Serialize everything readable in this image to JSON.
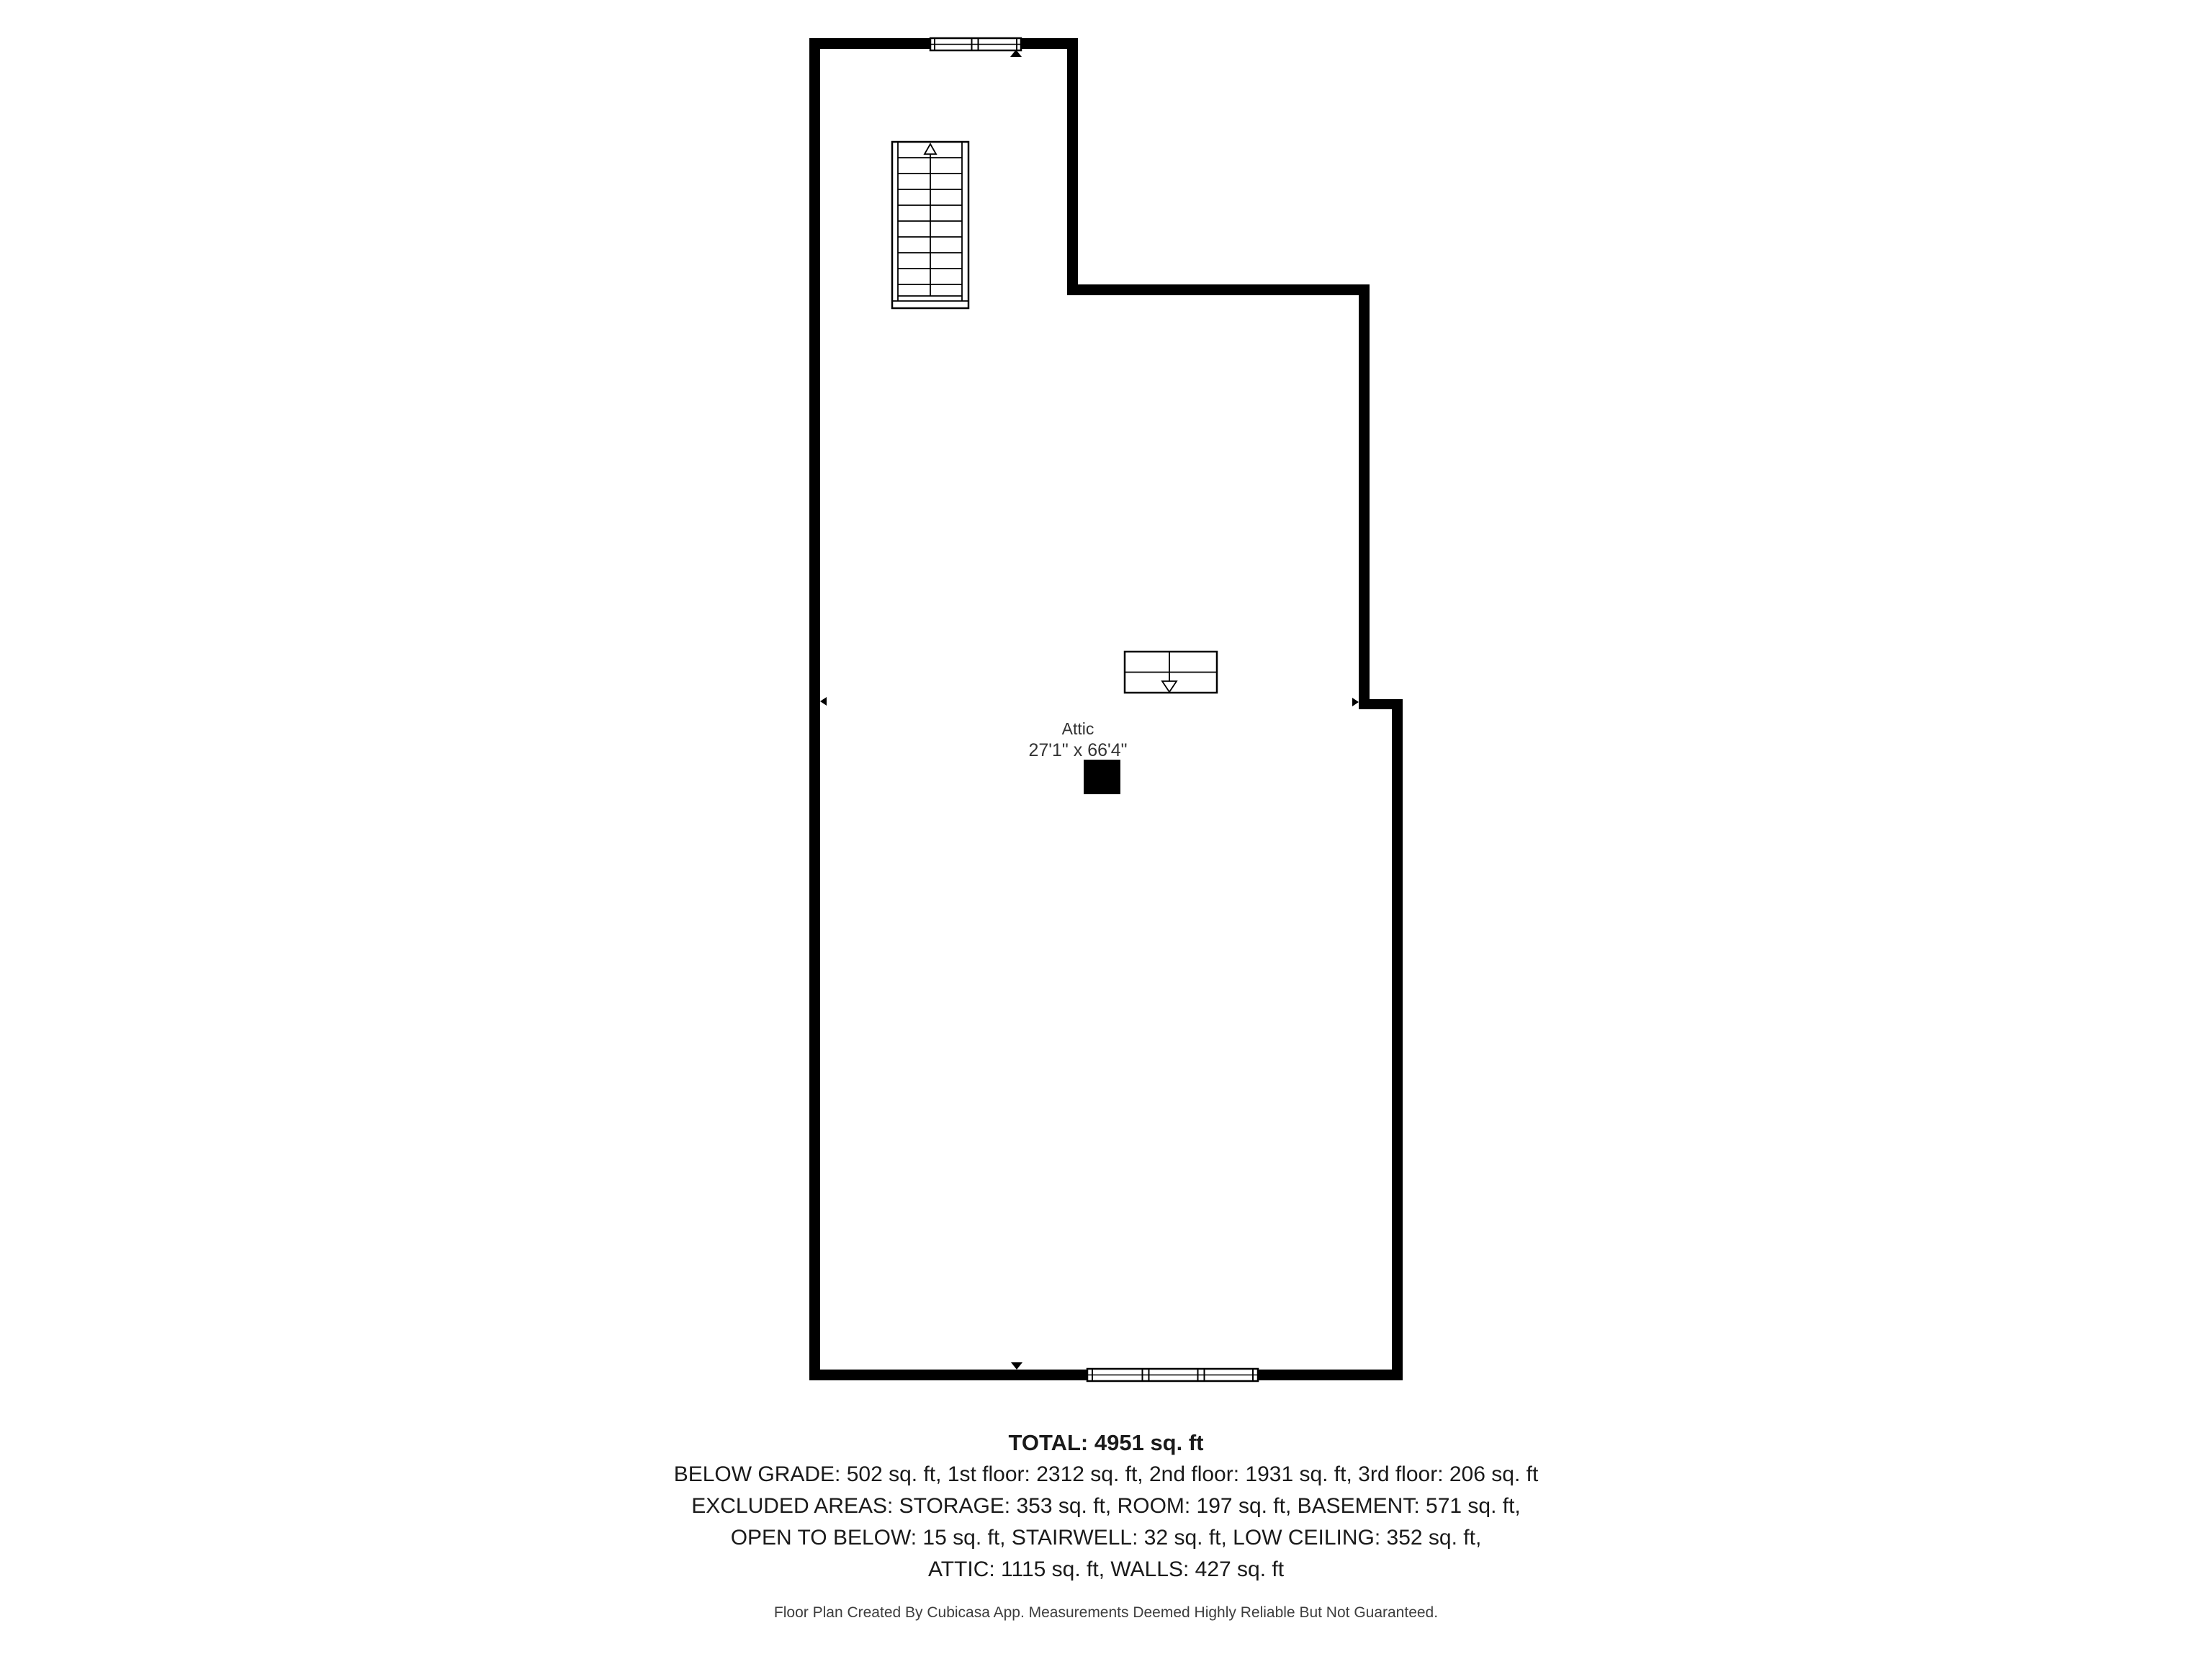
{
  "colors": {
    "wall": "#000000",
    "label_text": "#333333",
    "summary_text": "#1a1a1a",
    "footer_text": "#3d3d3d",
    "background": "#ffffff"
  },
  "plan": {
    "room_label": "Attic",
    "room_dimensions": "27'1\" x 66'4\""
  },
  "summary": {
    "total": "TOTAL: 4951 sq. ft",
    "lines": [
      "BELOW GRADE: 502 sq. ft, 1st floor: 2312 sq. ft, 2nd floor: 1931 sq. ft, 3rd floor: 206 sq. ft",
      "EXCLUDED AREAS: STORAGE: 353 sq. ft, ROOM: 197 sq. ft, BASEMENT: 571 sq. ft,",
      "OPEN TO BELOW: 15 sq. ft, STAIRWELL: 32 sq. ft, LOW CEILING: 352 sq. ft,",
      "ATTIC: 1115 sq. ft, WALLS: 427 sq. ft"
    ]
  },
  "footer": "Floor Plan Created By Cubicasa App. Measurements Deemed Highly Reliable But Not Guaranteed."
}
